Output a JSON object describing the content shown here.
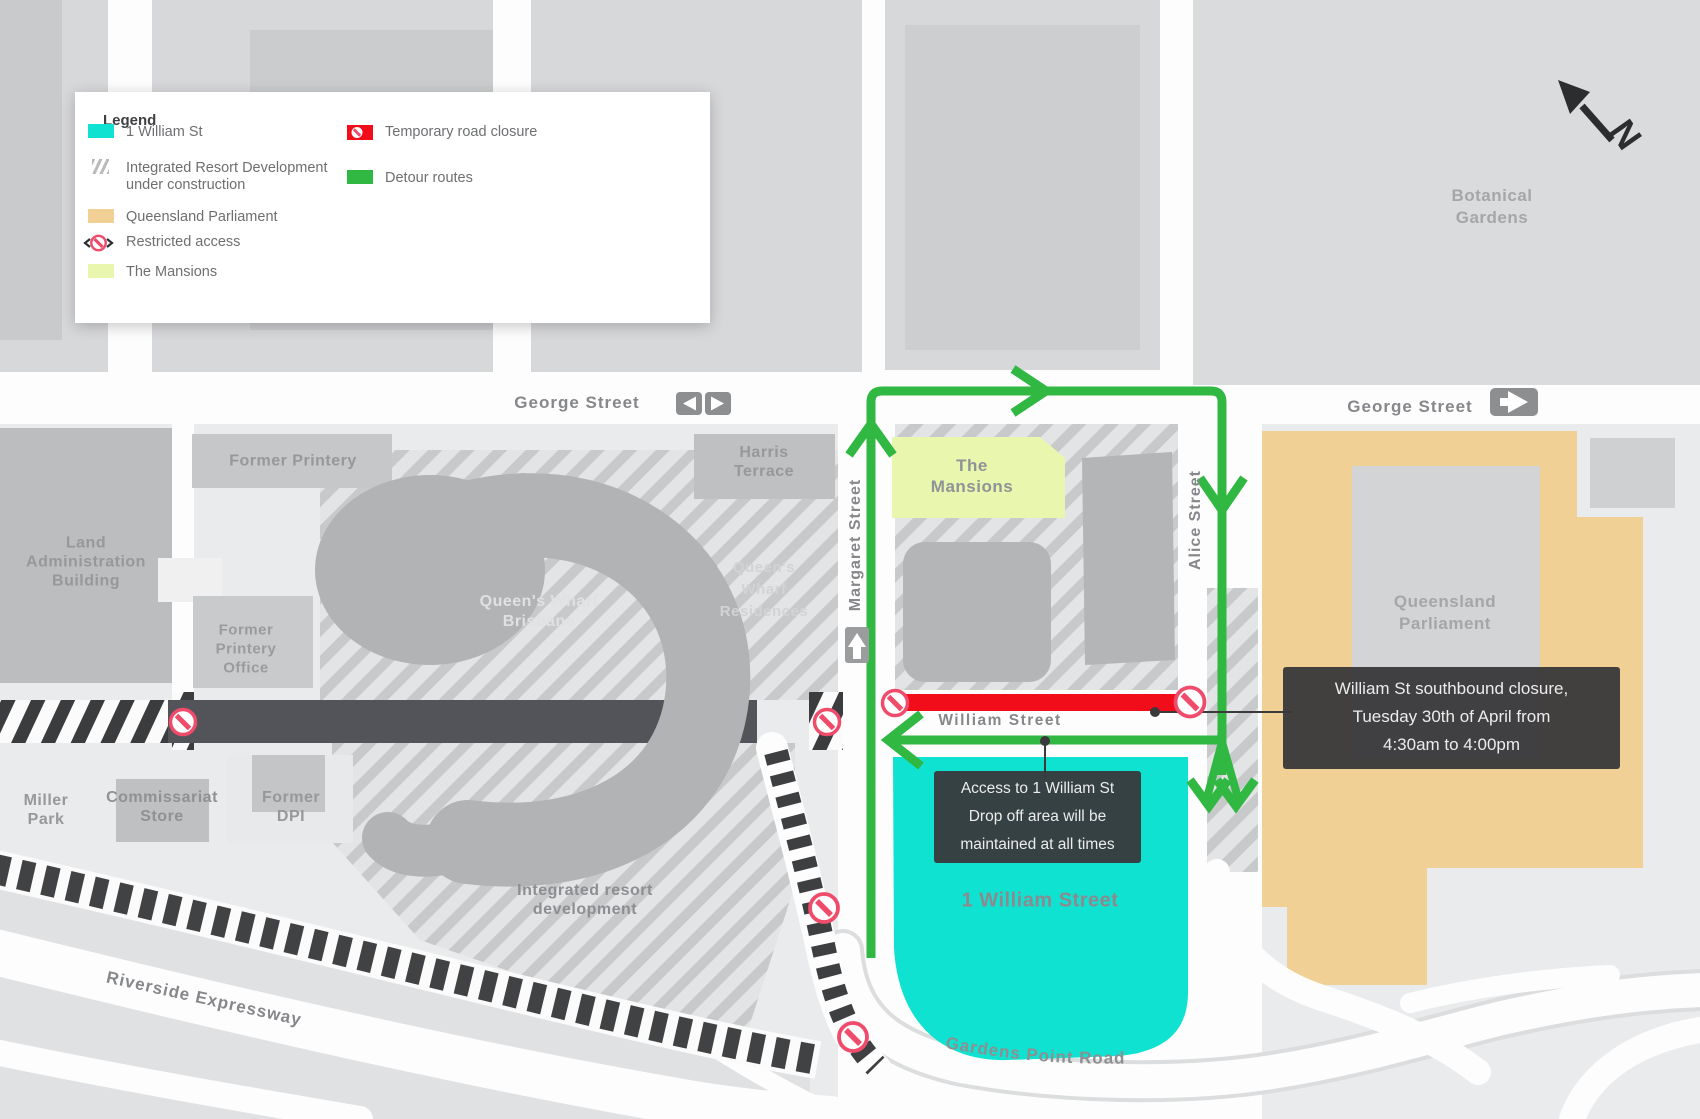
{
  "legend": {
    "title": "Legend",
    "items": [
      {
        "type": "william-st-swatch",
        "label": "1 William St"
      },
      {
        "type": "construction-hatch-swatch",
        "lines": [
          "Integrated Resort Development",
          "under construction"
        ]
      },
      {
        "type": "parliament-swatch",
        "label": "Queensland Parliament"
      },
      {
        "type": "restricted-access-icon",
        "label": "Restricted access"
      },
      {
        "type": "mansions-swatch",
        "label": "The Mansions"
      },
      {
        "type": "road-closure-swatch",
        "label": "Temporary road closure"
      },
      {
        "type": "detour-swatch",
        "label": "Detour routes"
      }
    ]
  },
  "streets": {
    "george_left": "George Street",
    "george_right": "George Street",
    "margaret": "Margaret Street",
    "alice": "Alice Street",
    "william": "William Street",
    "gardens_point": "Gardens Point Road",
    "riverside": "Riverside Expressway"
  },
  "places": {
    "botanical": [
      "Botanical",
      "Gardens"
    ],
    "land": [
      "Land",
      "Administration",
      "Building"
    ],
    "former_printery": "Former Printery",
    "harris": [
      "Harris",
      "Terrace"
    ],
    "queens_wharf_brisbane": [
      "Queen's Wharf",
      "Brisbane"
    ],
    "queens_wharf_residences": [
      "Queen's",
      "Wharf",
      "Residences"
    ],
    "former_printery_office": [
      "Former",
      "Printery",
      "Office"
    ],
    "miller_park": [
      "Miller",
      "Park"
    ],
    "commissariat_store": [
      "Commissariat",
      "Store"
    ],
    "former_dpi": [
      "Former",
      "DPI"
    ],
    "integrated_resort": [
      "Integrated resort",
      "development"
    ],
    "the_mansions": [
      "The",
      "Mansions"
    ],
    "queensland_parliament": [
      "Queensland",
      "Parliament"
    ],
    "one_william_street": "1 William Street"
  },
  "callouts": {
    "closure": [
      "William St southbound closure,",
      "Tuesday 30th of April from",
      "4:30am to 4:00pm"
    ],
    "access": [
      "Access to 1 William St",
      "Drop off area will be",
      "maintained at all times"
    ]
  },
  "compass": {
    "label": "N"
  },
  "colors": {
    "william_st": "#0fe2d0",
    "parliament": "#f1d096",
    "mansions": "#e9f6ad",
    "closure": "#f20d1a",
    "detour": "#30b843",
    "restricted_ring": "#ef4b6b",
    "closed_road_dark": "#53545a"
  }
}
